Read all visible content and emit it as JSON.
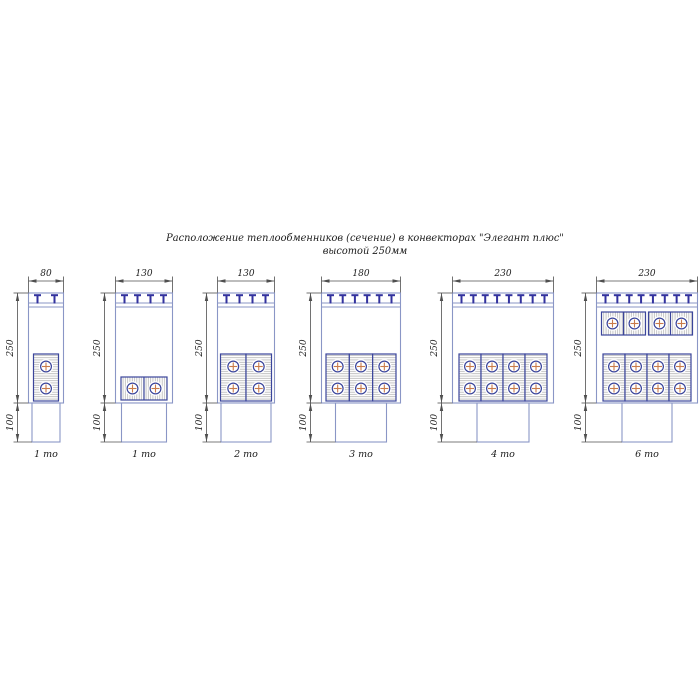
{
  "title": {
    "line1": "Расположение теплообменников (сечение) в конвекторах \"Элегант плюс\"",
    "line2": "высотой 250мм"
  },
  "diagrams": [
    {
      "name": "convector-80-1to",
      "width_mm": "80",
      "height_mm": "250",
      "base_mm": "100",
      "type_label": "1 то",
      "grille_slats": 2,
      "exchanger_rows": [
        {
          "orientation": "vertical",
          "count": 1,
          "row": "lower"
        }
      ]
    },
    {
      "name": "convector-130-1to",
      "width_mm": "130",
      "height_mm": "250",
      "base_mm": "100",
      "type_label": "1 то",
      "grille_slats": 4,
      "exchanger_rows": [
        {
          "orientation": "horizontal",
          "count": 1,
          "row": "lower"
        }
      ]
    },
    {
      "name": "convector-130-2to",
      "width_mm": "130",
      "height_mm": "250",
      "base_mm": "100",
      "type_label": "2 то",
      "grille_slats": 4,
      "exchanger_rows": [
        {
          "orientation": "vertical",
          "count": 2,
          "row": "lower"
        }
      ]
    },
    {
      "name": "convector-180-3to",
      "width_mm": "180",
      "height_mm": "250",
      "base_mm": "100",
      "type_label": "3 то",
      "grille_slats": 6,
      "exchanger_rows": [
        {
          "orientation": "vertical",
          "count": 3,
          "row": "lower"
        }
      ]
    },
    {
      "name": "convector-230-4to",
      "width_mm": "230",
      "height_mm": "250",
      "base_mm": "100",
      "type_label": "4 то",
      "grille_slats": 8,
      "exchanger_rows": [
        {
          "orientation": "vertical",
          "count": 4,
          "row": "lower"
        }
      ]
    },
    {
      "name": "convector-230-6to",
      "width_mm": "230",
      "height_mm": "250",
      "base_mm": "100",
      "type_label": "6 то",
      "grille_slats": 8,
      "exchanger_rows": [
        {
          "orientation": "horizontal",
          "count": 2,
          "row": "upper"
        },
        {
          "orientation": "vertical",
          "count": 4,
          "row": "lower"
        }
      ]
    }
  ],
  "colors": {
    "background": "#ffffff",
    "body_line_blue": "#8a96c6",
    "grille_marker_navy": "#32329e",
    "exchanger_border_navy": "#3b459b",
    "hatch_gray": "#ababab",
    "tube_ring_navy": "#3b459b",
    "tube_cross_orange": "#c97b4a",
    "dimension_gray": "#4f4f4f",
    "text_black": "#1c1c1c"
  }
}
